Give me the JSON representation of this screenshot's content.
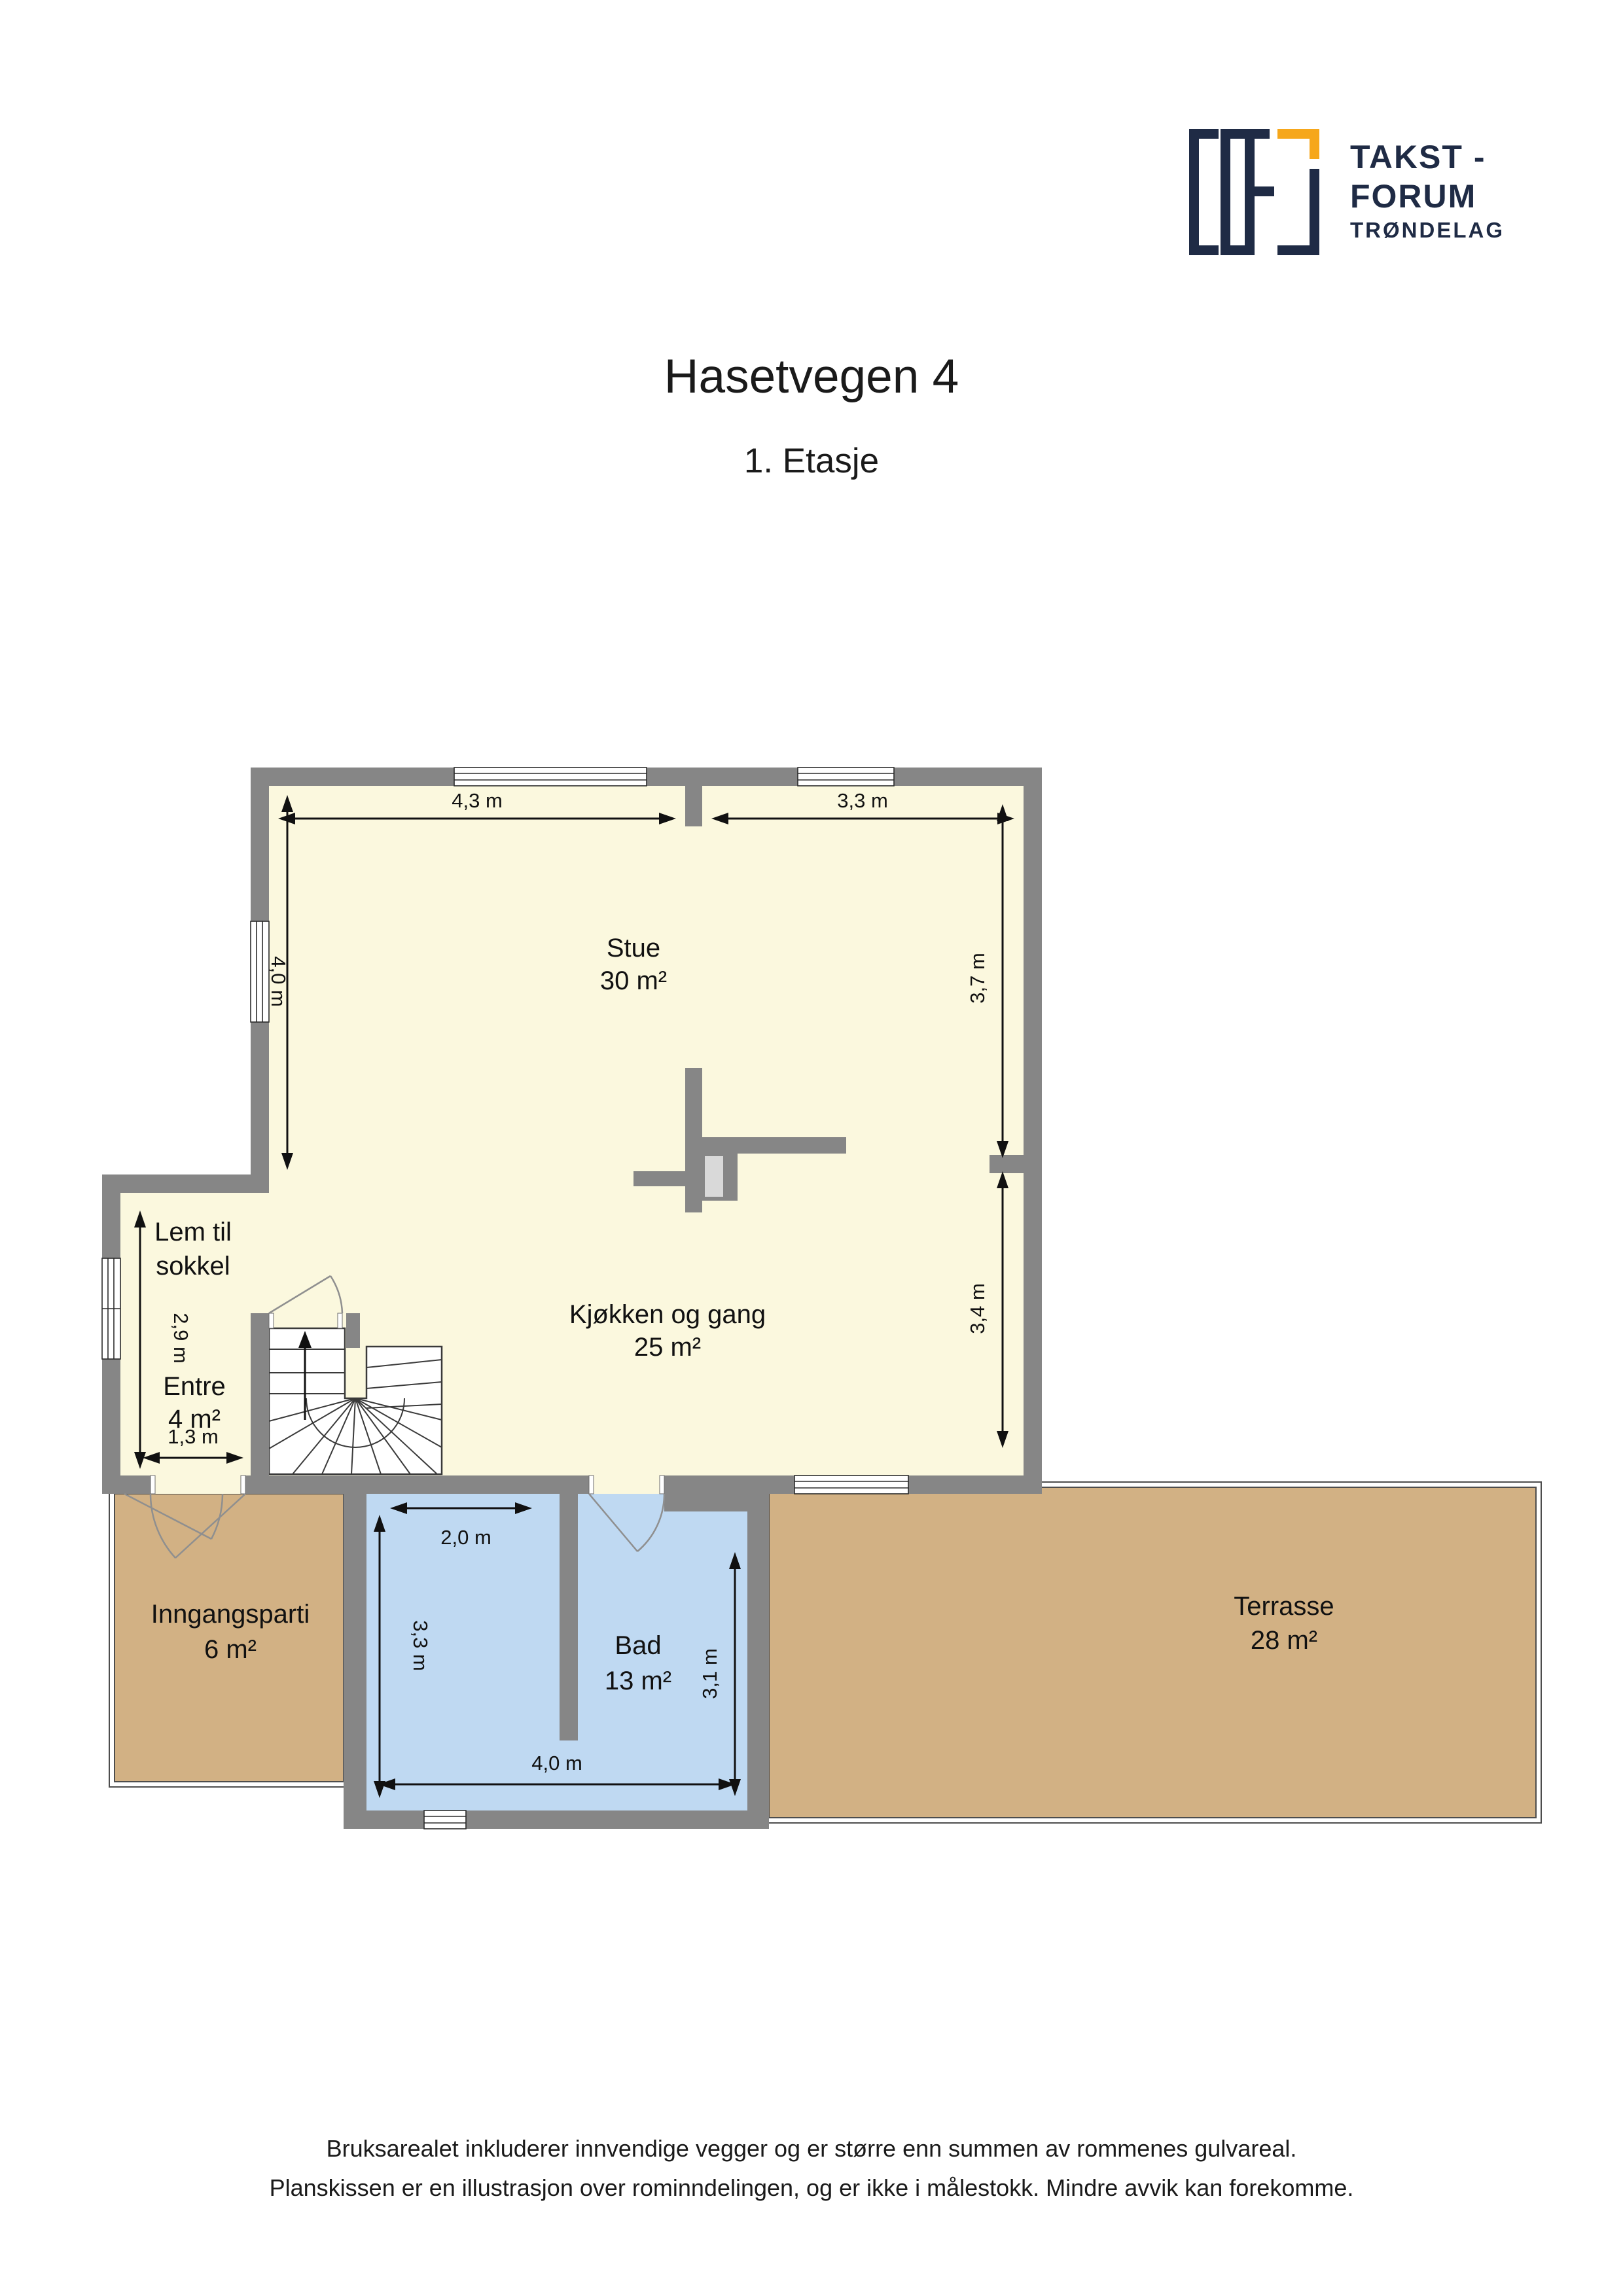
{
  "page": {
    "title": "Hasetvegen 4",
    "subtitle": "1. Etasje",
    "footer_line1": "Bruksarealet inkluderer innvendige vegger og er større enn summen av rommenes gulvareal.",
    "footer_line2": "Planskissen er en illustrasjon over rominndelingen, og er ikke i målestokk. Mindre avvik kan forekomme."
  },
  "logo": {
    "line1": "TAKST -",
    "line2": "FORUM",
    "line3": "TRØNDELAG"
  },
  "rooms": {
    "stue": {
      "name": "Stue",
      "area": "30 m²"
    },
    "kjokken_og_gang": {
      "name": "Kjøkken og gang",
      "area": "25 m²"
    },
    "lem_til_sokkel": {
      "name_line1": "Lem til",
      "name_line2": "sokkel"
    },
    "entre": {
      "name": "Entre",
      "area": "4 m²"
    },
    "inngangsparti": {
      "name": "Inngangsparti",
      "area": "6 m²"
    },
    "bad": {
      "name": "Bad",
      "area": "13 m²"
    },
    "terrasse": {
      "name": "Terrasse",
      "area": "28 m²"
    }
  },
  "dimensions": {
    "stue_top_width": "4,3 m",
    "kjokken_top_width": "3,3 m",
    "stue_left_height": "4,0 m",
    "stue_right_height": "3,7 m",
    "kjokken_right_height": "3,4 m",
    "entre_left_height": "2,9 m",
    "entre_bottom_width": "1,3 m",
    "bad_inner_width": "2,0 m",
    "bad_left_height": "3,3 m",
    "bad_right_height": "3,1 m",
    "bad_bottom_width": "4,0 m"
  },
  "colors": {
    "wall": "#868686",
    "floor": "#FBF8DE",
    "terrace": "#D2B184",
    "bath": "#BFD9F2",
    "chimney_inner": "#D9D9D9",
    "logo_navy": "#1F2B45",
    "logo_orange": "#F6A71B"
  }
}
